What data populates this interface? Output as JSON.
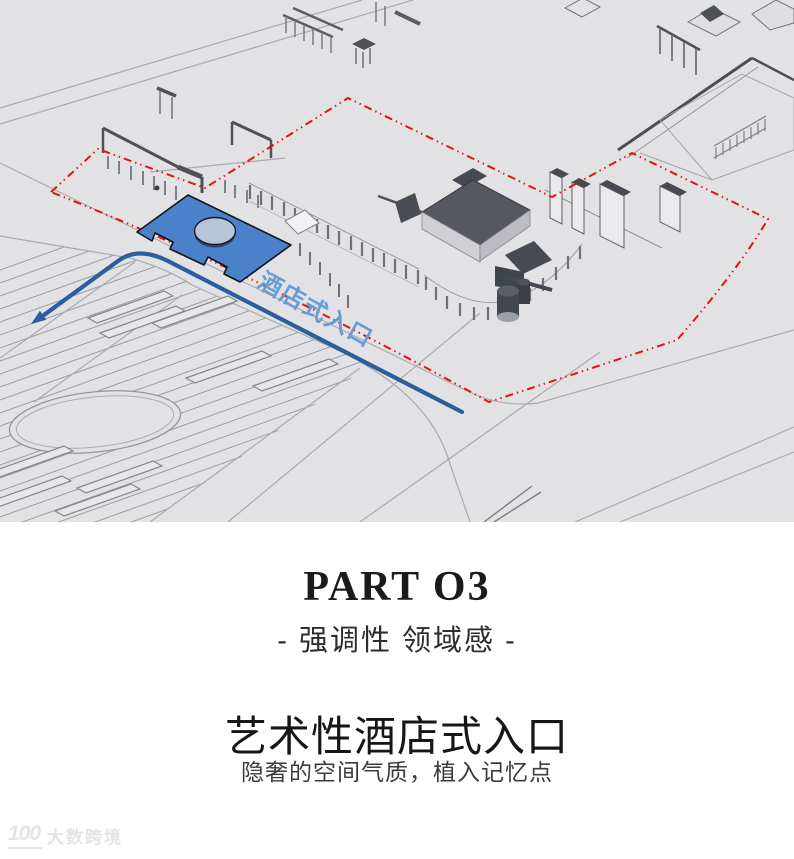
{
  "diagram": {
    "entrance_label": "酒店式入口",
    "colors": {
      "background": "#e2e2e5",
      "line_gray": "#a9a9af",
      "wall_dark": "#4e5257",
      "red_boundary": "#e11313",
      "route_blue": "#2b5e9e",
      "plaza_blue": "#4b80cb",
      "plaza_ellipse": "#b7c5d9",
      "label_blue": "#669dd6"
    }
  },
  "caption": {
    "part_title": "PART O3",
    "part_subtitle": "- 强调性 领域感 -",
    "headline": "艺术性酒店式入口",
    "subheadline": "隐奢的空间气质，植入记忆点"
  },
  "watermark": {
    "logo": "100",
    "text": "大数跨境"
  }
}
